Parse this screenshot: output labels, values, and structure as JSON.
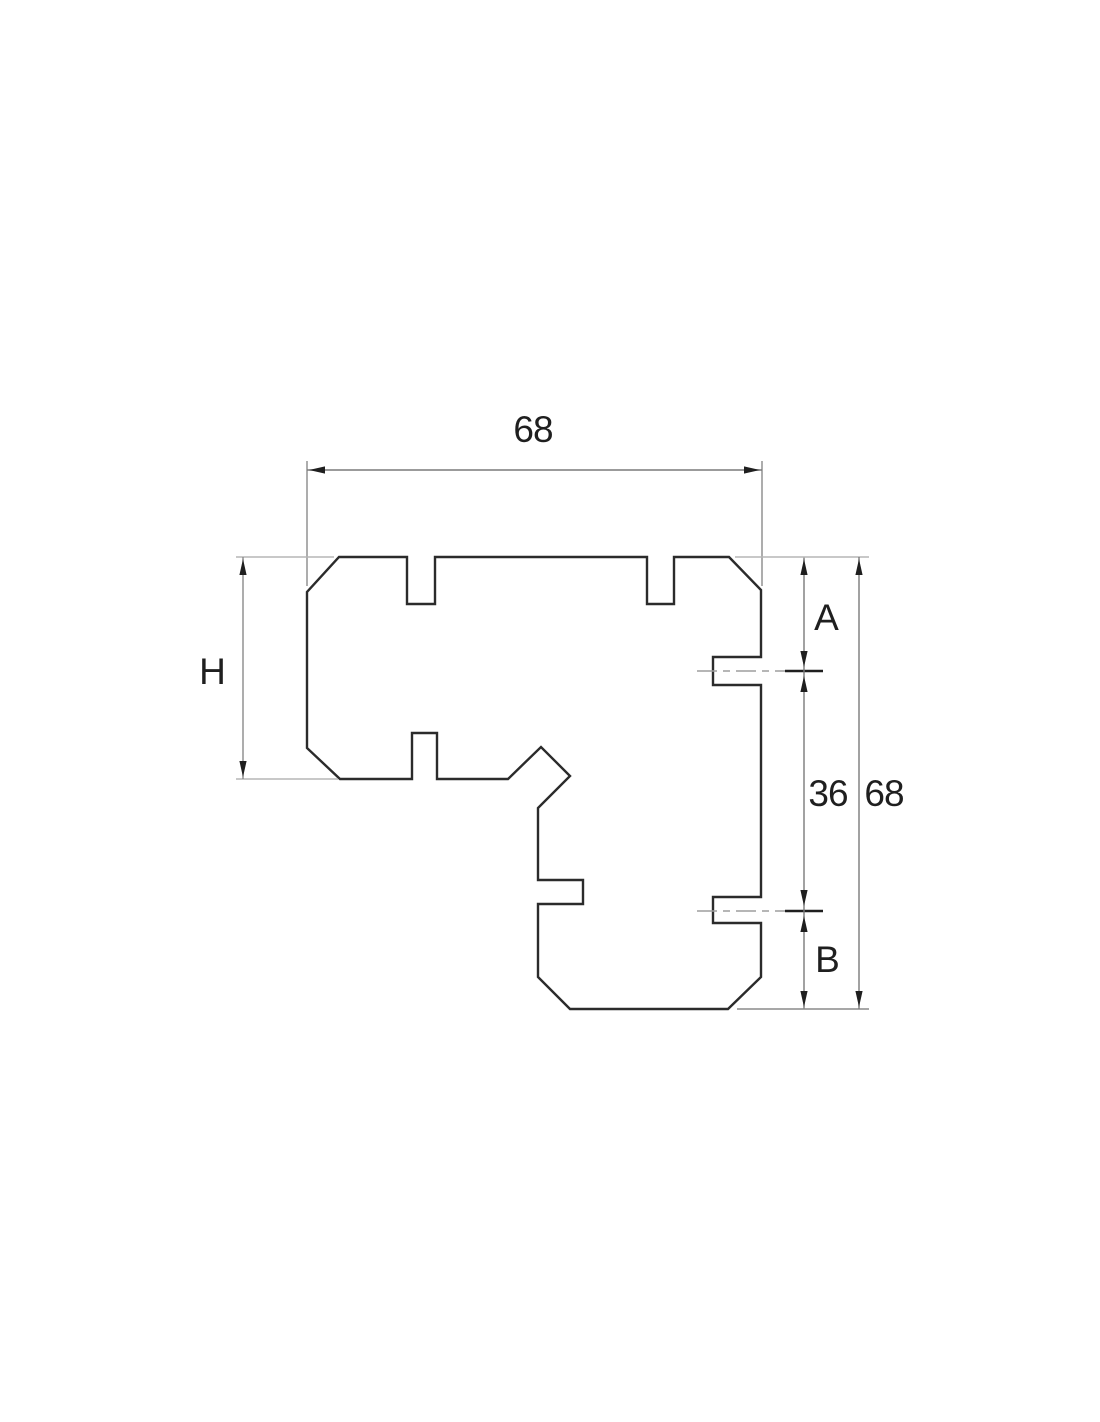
{
  "drawing": {
    "type": "technical cross-section drawing",
    "subject": "corner profile with chamfered corners, top notches and side grooves",
    "dimensions": {
      "top_width": "68",
      "left_height": "H",
      "right_segment_top": "A",
      "right_segment_middle": "36",
      "right_segment_bottom": "B",
      "right_total_height": "68"
    },
    "colors": {
      "background": "#ffffff",
      "outline": "#2b2b2b",
      "dimension_line": "#7a7a7a",
      "extension_line_light": "#b5b5b5",
      "extension_line_dark": "#8a8a8a",
      "centerline": "#9e9e9e",
      "arrow_and_text": "#1f1f1f"
    }
  }
}
